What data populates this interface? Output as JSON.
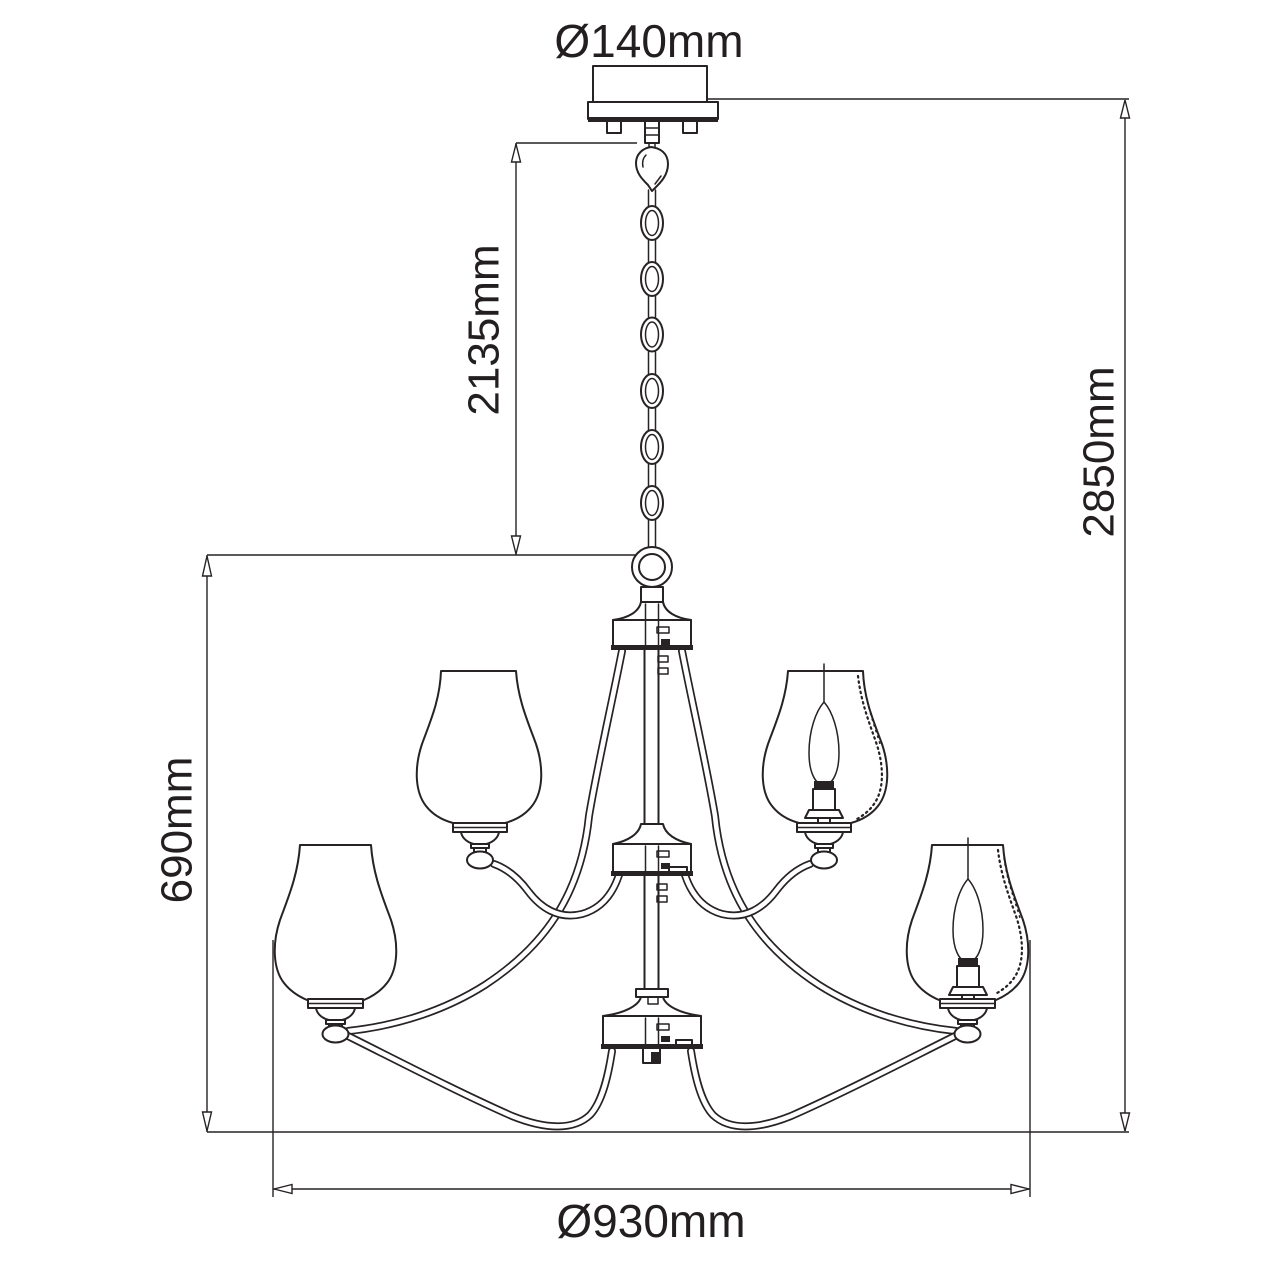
{
  "title": "Chandelier technical dimension drawing",
  "colors": {
    "line": "#272223",
    "text": "#231f20",
    "green_arrow": "#62bb46",
    "background": "#ffffff"
  },
  "dimensions": {
    "canopy_diameter": "Ø140mm",
    "chain_length": "2135mm",
    "total_height": "2850mm",
    "body_height": "690mm",
    "body_diameter": "Ø930mm"
  }
}
